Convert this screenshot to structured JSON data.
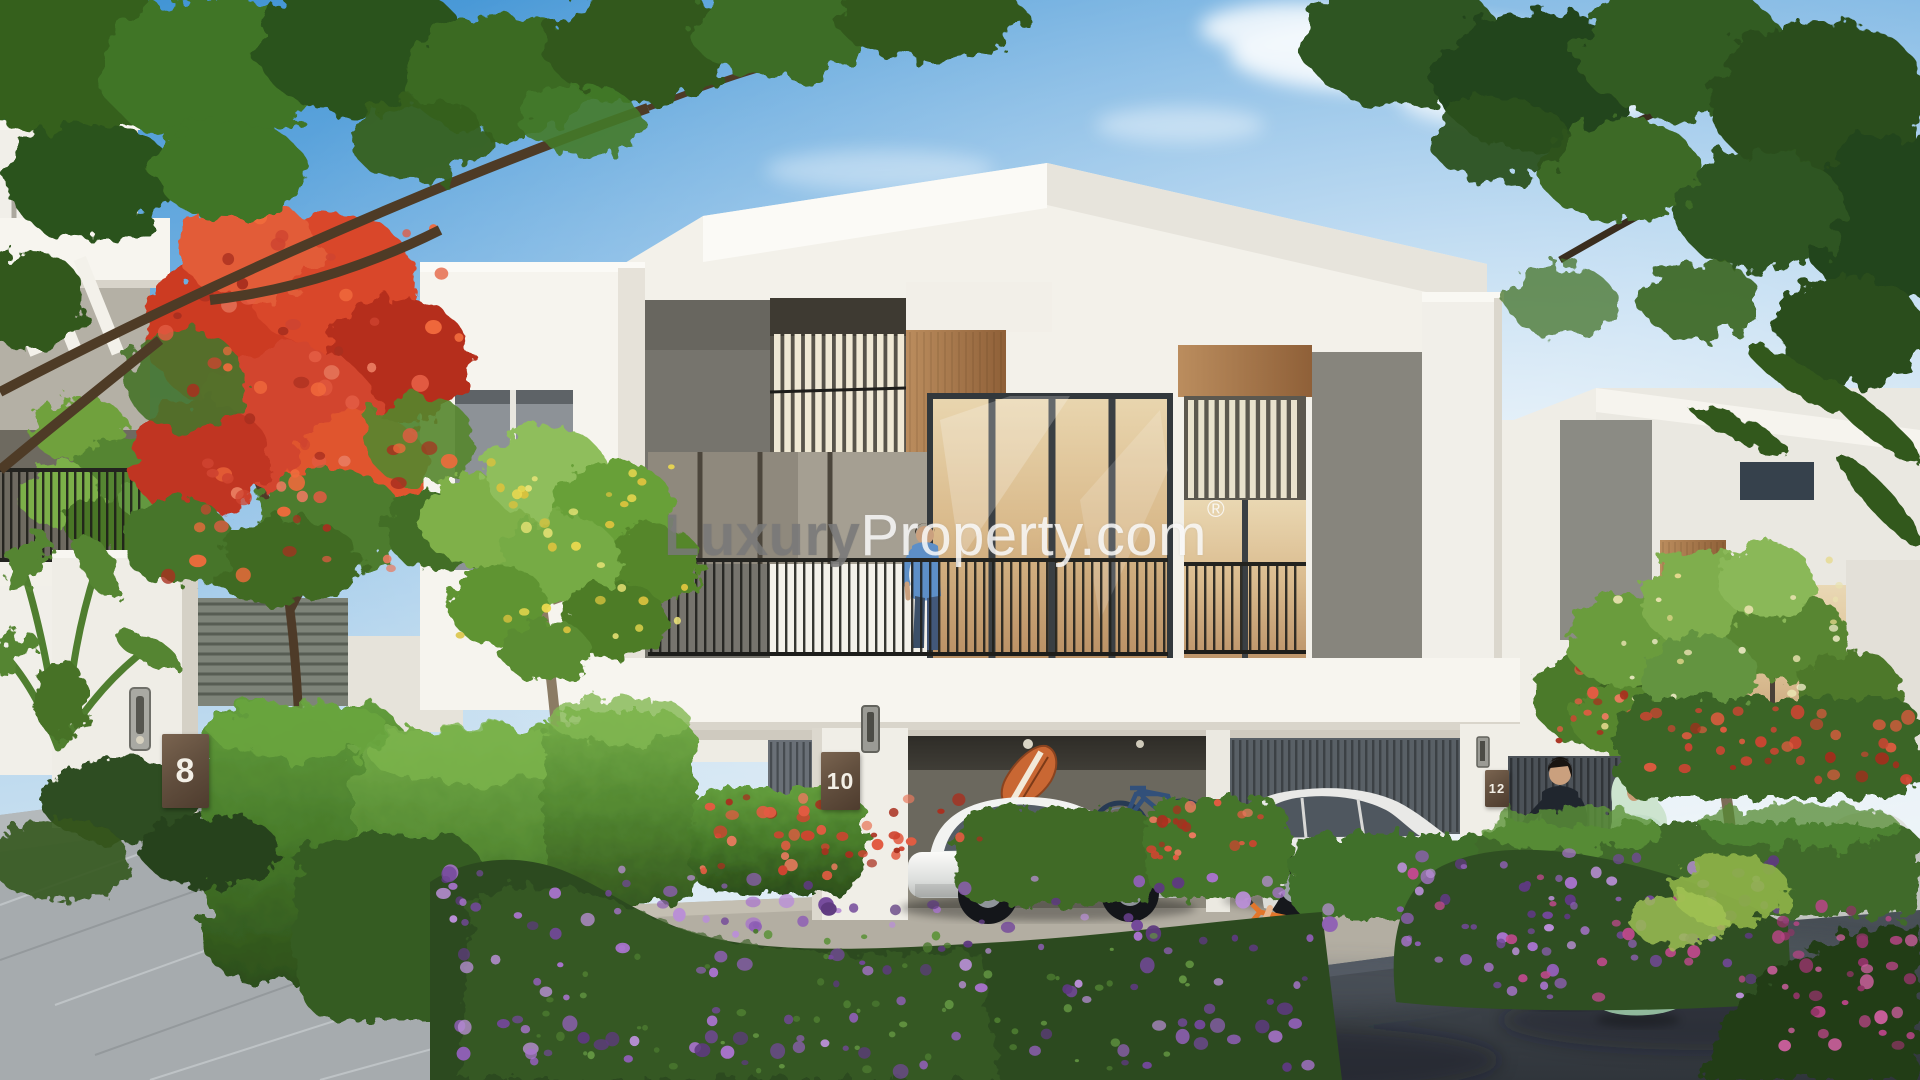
{
  "scene": {
    "description": "Daylight 3D rendering of a modern two-storey townhouse community with landscaped street, garages with cars, and residents"
  },
  "watermark": {
    "part_bold": "Luxury",
    "part_regular": "Property.com",
    "registered_mark": "®"
  },
  "house_plaques": [
    {
      "number": "8"
    },
    {
      "number": "10"
    },
    {
      "number": "12"
    }
  ],
  "colors": {
    "sky_blue": "#4e9cd8",
    "sky_horizon": "#e7f0f6",
    "wall_white": "#f2f0ea",
    "concrete_gray": "#7b7973",
    "wood_brown": "#a97e55",
    "glass_amber": "#e3c79c",
    "hedge_green": "#4a7a2e",
    "flower_purple": "#8f5fb5",
    "flame_tree_red": "#d2452f",
    "plaque_brown": "#5d4a3a",
    "road_gray": "#3a4046",
    "watermark_gray": "#8a8a8a",
    "watermark_white": "#ffffff"
  }
}
